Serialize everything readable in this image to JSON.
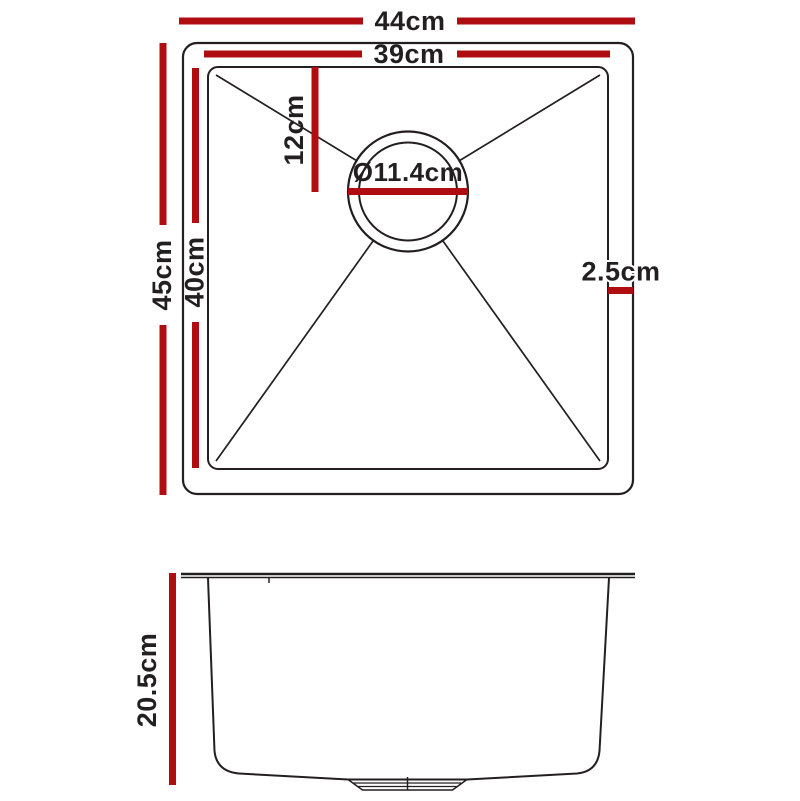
{
  "colors": {
    "accent_red": "#b00d12",
    "line_black": "#231f20",
    "background": "#ffffff"
  },
  "top_view": {
    "overall_width_label": "44cm",
    "bowl_width_label": "39cm",
    "overall_depth_label": "45cm",
    "bowl_depth_label": "40cm",
    "drain_offset_label": "12cm",
    "drain_diameter_label": "Ø11.4cm",
    "rim_width_label": "2.5cm"
  },
  "side_view": {
    "bowl_height_label": "20.5cm"
  }
}
